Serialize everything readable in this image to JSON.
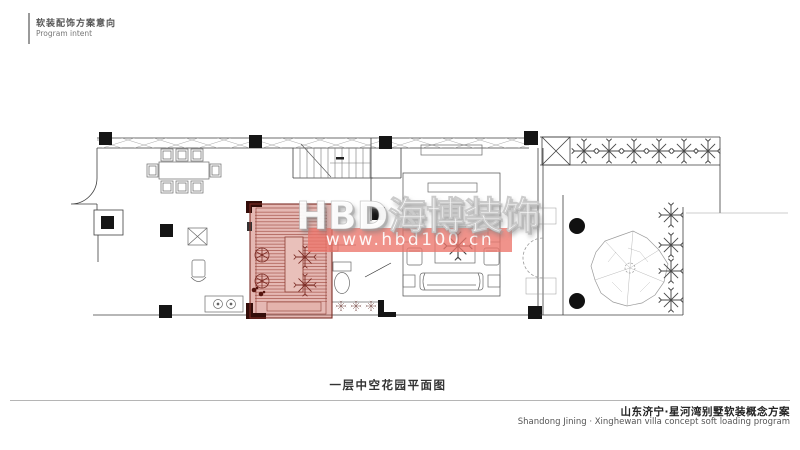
{
  "header": {
    "title_cn": "软装配饰方案意向",
    "title_en": "Program intent"
  },
  "watermark": {
    "brand": "HBD海博装饰",
    "url": "www.hbd100.cn"
  },
  "caption": "一层中空花园平面图",
  "footer": {
    "title_cn": "山东济宁·星河湾别墅软装概念方案",
    "title_en": "Shandong Jining · Xinghewan villa concept soft loading program"
  },
  "colors": {
    "highlight": "rgba(194,86,74,0.42)",
    "stripe": "#9c463c",
    "banner": "rgba(236,116,106,0.78)",
    "corner": "#330d09",
    "line": "#3f3f3f"
  }
}
